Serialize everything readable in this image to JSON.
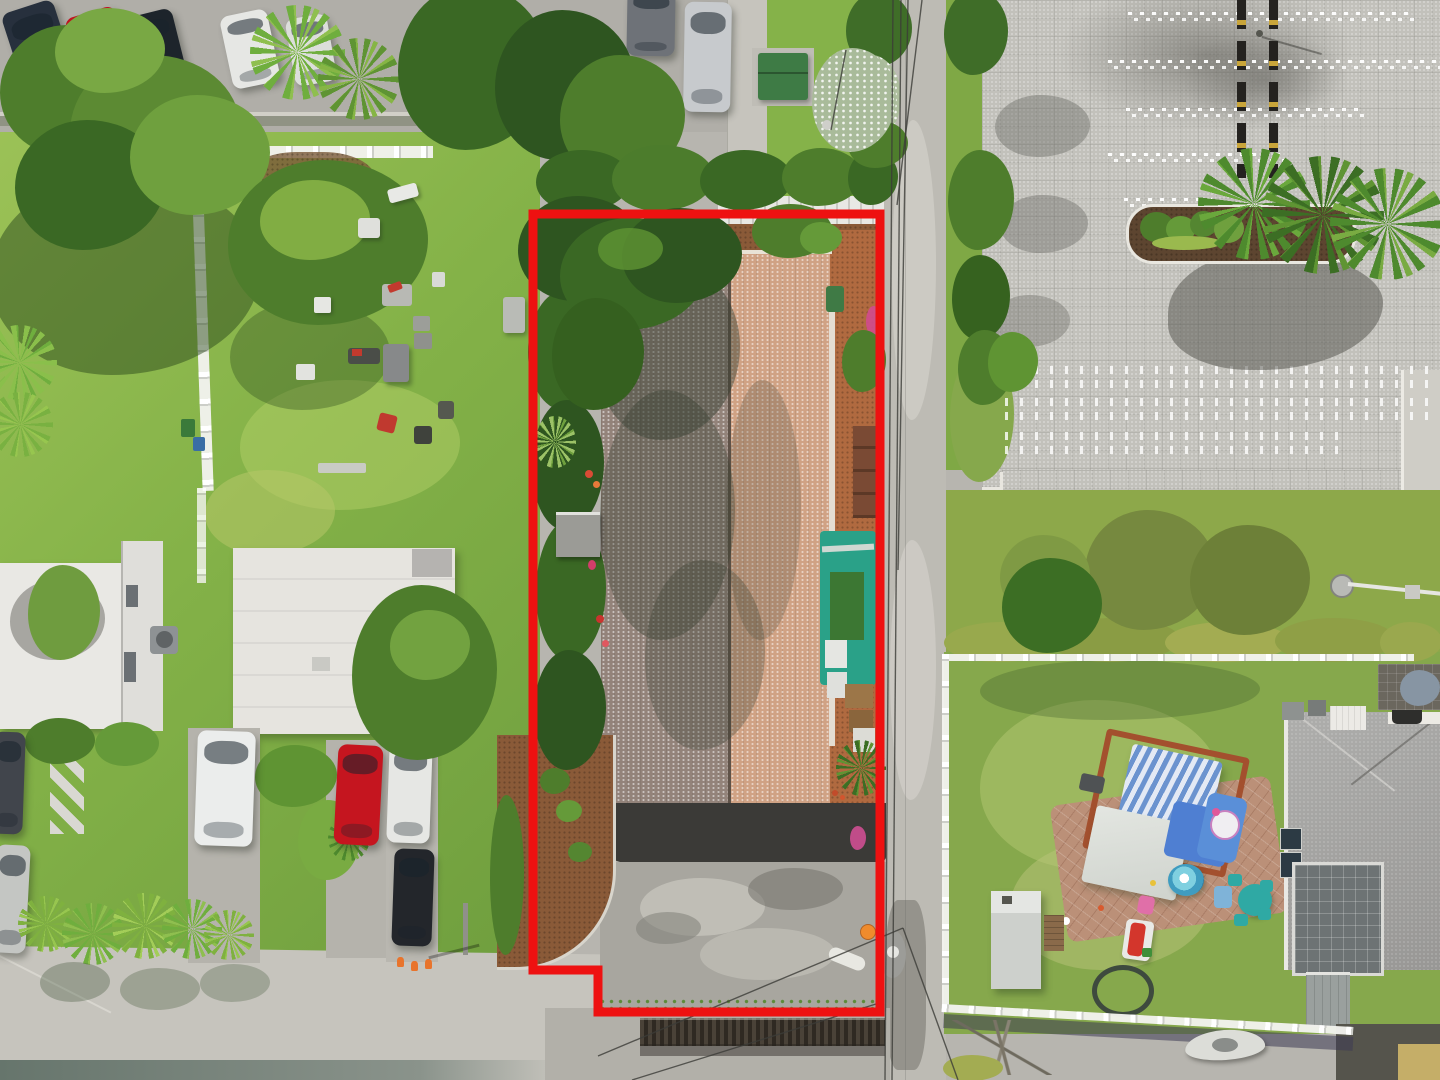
{
  "meta": {
    "description": "Aerial drone photograph of a commercial property parcel outlined in red, flanked by a grassy yard with lawn furniture on the left, a narrow street, a large paver parking lot on the upper right and a fenced residential backyard with play equipment on the lower right.",
    "image_kind": "aerial-photo"
  },
  "palette": {
    "boundary_red": "#ee1111",
    "wire_dark": "#3c3c38",
    "concrete_road": "#bdbbb4",
    "concrete_light": "#c9c7c0",
    "asphalt_dark": "#3b3a37",
    "driveway_gray": "#a8a69f",
    "paver_lot": "#c2c1bb",
    "grass_bright": "#8fbb4d",
    "grass_light": "#a8cc5e",
    "grass_dark": "#5d8a35",
    "tree_dark": "#2e5520",
    "tree_mid": "#4e7d2c",
    "tree_light": "#79a844",
    "hedge_yellow": "#98a94d",
    "mulch_brown": "#8a5a38",
    "mulch_orange": "#b06a40",
    "roof_tan": "#d0a284",
    "roof_shadow": "#93837a",
    "white_building": "#e9e8e4",
    "teal_canopy": "#2aa188",
    "turf_green": "#3c7733",
    "backyard_grass": "#86a84c",
    "house_roof": "#a2a19f",
    "fence_white": "#f2f2ee",
    "pool_blue": "#53b2cd",
    "canopy_blue": "#6b93cf",
    "pergola_wood": "#a3502e",
    "patio_brick": "#bb9078",
    "teal_furniture": "#2fa9a4",
    "slide_red": "#d3362c",
    "cone_orange": "#e8742c"
  },
  "boundary": {
    "color": "#ee1111",
    "stroke_width": 9,
    "points": [
      [
        533,
        214
      ],
      [
        880,
        214
      ],
      [
        880,
        1012
      ],
      [
        598,
        1012
      ],
      [
        598,
        970
      ],
      [
        533,
        970
      ]
    ]
  },
  "cars": [
    {
      "name": "car-sedan-navy",
      "x": 16,
      "y": 4,
      "w": 54,
      "h": 110,
      "rot": -18,
      "color": "#27303d"
    },
    {
      "name": "car-sedan-red",
      "x": 78,
      "y": 10,
      "w": 52,
      "h": 106,
      "rot": -17,
      "color": "#bf1320"
    },
    {
      "name": "car-suv-black",
      "x": 132,
      "y": 12,
      "w": 50,
      "h": 88,
      "rot": -14,
      "color": "#1d242b"
    },
    {
      "name": "car-sedan-white",
      "x": 226,
      "y": 12,
      "w": 48,
      "h": 74,
      "rot": -12,
      "color": "#e6e7e4"
    },
    {
      "name": "car-sedan-white-2",
      "x": 290,
      "y": 16,
      "w": 42,
      "h": 68,
      "rot": -10,
      "color": "#dcdedb"
    },
    {
      "name": "car-sedan-gray",
      "x": 627,
      "y": -10,
      "w": 48,
      "h": 66,
      "rot": 1,
      "color": "#6e7278"
    },
    {
      "name": "car-sedan-silver",
      "x": 684,
      "y": 2,
      "w": 47,
      "h": 110,
      "rot": 1,
      "color": "#c7cacd"
    },
    {
      "name": "car-edge-dark",
      "x": -8,
      "y": 732,
      "w": 32,
      "h": 102,
      "rot": 2,
      "color": "#41454c"
    },
    {
      "name": "car-edge-silver",
      "x": -6,
      "y": 845,
      "w": 34,
      "h": 108,
      "rot": 3,
      "color": "#c4c6c3"
    },
    {
      "name": "van-white",
      "x": 196,
      "y": 731,
      "w": 58,
      "h": 115,
      "rot": 2,
      "color": "#ebedec"
    },
    {
      "name": "car-sedan-red-2",
      "x": 336,
      "y": 745,
      "w": 45,
      "h": 100,
      "rot": 3,
      "color": "#c5151f"
    },
    {
      "name": "truck-white",
      "x": 388,
      "y": 742,
      "w": 43,
      "h": 101,
      "rot": 2,
      "color": "#e6e7e4"
    },
    {
      "name": "car-sedan-black",
      "x": 393,
      "y": 849,
      "w": 40,
      "h": 97,
      "rot": 2,
      "color": "#23262b"
    }
  ],
  "wires": [
    [
      893,
      0,
      885,
      1080
    ],
    [
      901,
      0,
      892,
      1080
    ],
    [
      908,
      0,
      898,
      570
    ],
    [
      922,
      0,
      897,
      205
    ],
    [
      598,
      1056,
      903,
      928
    ],
    [
      632,
      1080,
      876,
      1004
    ],
    [
      903,
      928,
      958,
      1080
    ],
    [
      846,
      50,
      831,
      130
    ]
  ],
  "objects": [
    "red property boundary outline",
    "brown shingled roof of listed building",
    "black asphalt rear apron",
    "weathered concrete driveway",
    "corrugated rear fence",
    "street with utility wires and street lamp",
    "large paver parking lot with white dotted stalls",
    "yellow-and-black wheel stops",
    "palm tree island with mulch bed",
    "grassy side yard with scattered lawn chairs and tables",
    "white picket fences",
    "two flat-roofed white apartment buildings",
    "parked cars along top parking row",
    "parked cars on lower-left pads",
    "orange traffic cones",
    "residential backyard with white rail fence",
    "pergola with blue striped canopy",
    "kiddie pool",
    "teal kids table set",
    "red toddler slide",
    "white storage shed",
    "gray shingle house roof with screened porch",
    "kayak on road shoulder",
    "green utility box",
    "white flowering trees",
    "hedge rows",
    "bougainvillea accents"
  ]
}
